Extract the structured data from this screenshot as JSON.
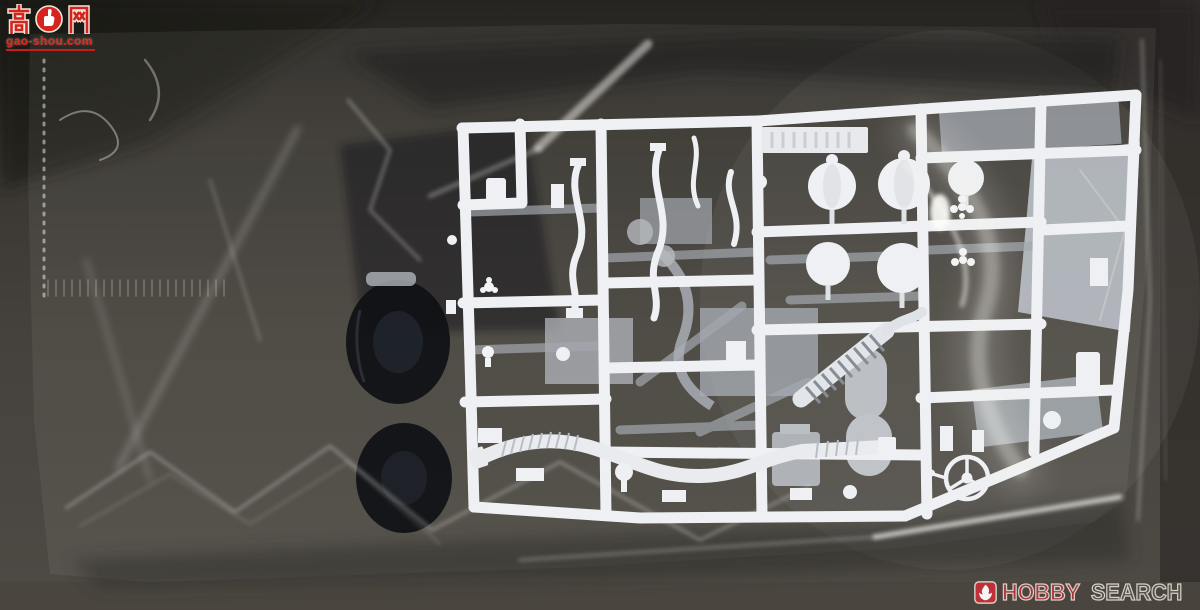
{
  "scene": {
    "description": "Photograph of a white plastic model-kit sprue (runner with molded parts) sealed inside a clear crinkled plastic bag, lying on a dark grey surface. Light grey parts and two black tires are visible behind the white runner.",
    "objects": {
      "bag": "clear plastic bag with wrinkle reflections",
      "white_sprue": "white sprue runner with dome parts, exhaust pipes, corrugated hose and steering wheel",
      "gray_parts": "light grey sprue parts beneath",
      "tires": "black rubber tires inside bag"
    }
  },
  "colors": {
    "background": "#46423d",
    "background_dark": "#232120",
    "bag_highlight": "#f4f3ee",
    "sprue_white": "#eef0f3",
    "gray_part": "#b2b8c0",
    "tire_black": "#101217",
    "watermark_red": "#d5231d",
    "hobby_red": "#b03440",
    "hobby_gray": "#55524e",
    "logo_outline": "#dcd6ca"
  },
  "watermarks": {
    "gaoshou": {
      "site_name": "高手网",
      "char_left": "高",
      "char_right": "网",
      "icon": "fist-icon",
      "domain": "gao-shou.com"
    },
    "hobbysearch": {
      "icon": "flame-icon",
      "word1": "HOBBY",
      "word2": "SEARCH"
    }
  }
}
